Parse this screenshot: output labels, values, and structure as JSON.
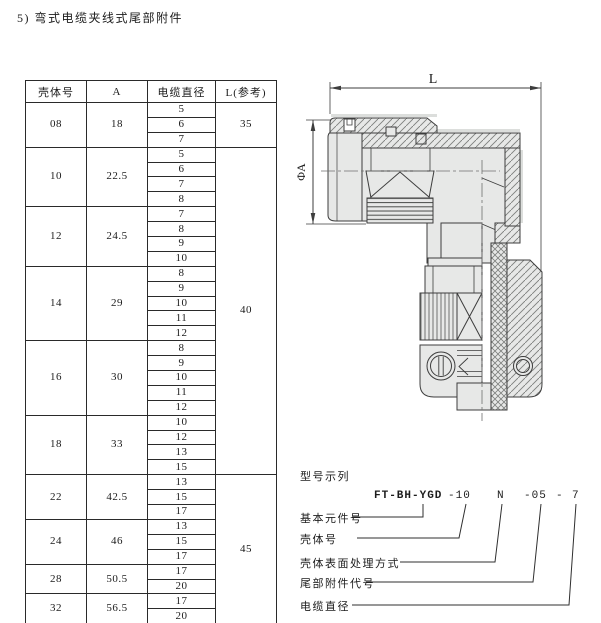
{
  "title": "5) 弯式电缆夹线式尾部附件",
  "colors": {
    "page": "#ffffff",
    "line": "#3d3d3d",
    "body_fill": "#e7e8e7",
    "table_line": "#2a2a2a"
  },
  "table": {
    "headers": [
      "壳体号",
      "A",
      "电缆直径",
      "L(参考)"
    ],
    "groups": [
      {
        "shell": "08",
        "a": "18",
        "diameters": [
          "5",
          "6",
          "7"
        ]
      },
      {
        "shell": "10",
        "a": "22.5",
        "diameters": [
          "5",
          "6",
          "7",
          "8"
        ]
      },
      {
        "shell": "12",
        "a": "24.5",
        "diameters": [
          "7",
          "8",
          "9",
          "10"
        ]
      },
      {
        "shell": "14",
        "a": "29",
        "diameters": [
          "8",
          "9",
          "10",
          "11",
          "12"
        ]
      },
      {
        "shell": "16",
        "a": "30",
        "diameters": [
          "8",
          "9",
          "10",
          "11",
          "12"
        ]
      },
      {
        "shell": "18",
        "a": "33",
        "diameters": [
          "10",
          "12",
          "13",
          "15"
        ]
      },
      {
        "shell": "22",
        "a": "42.5",
        "diameters": [
          "13",
          "15",
          "17"
        ]
      },
      {
        "shell": "24",
        "a": "46",
        "diameters": [
          "13",
          "15",
          "17"
        ]
      },
      {
        "shell": "28",
        "a": "50.5",
        "diameters": [
          "17",
          "20"
        ]
      },
      {
        "shell": "32",
        "a": "56.5",
        "diameters": [
          "17",
          "20"
        ]
      }
    ],
    "l_spans": [
      {
        "value": "35",
        "from_group": 0,
        "to_group": 0
      },
      {
        "value": "40",
        "from_group": 1,
        "to_group": 5
      },
      {
        "value": "45",
        "from_group": 6,
        "to_group": 9
      }
    ]
  },
  "drawing": {
    "dim_length_label": "L",
    "dim_diameter_label": "ΦA"
  },
  "designation": {
    "section_title": "型号示列",
    "code": [
      "FT-BH-YGD",
      "-10",
      "N",
      "-05",
      "-",
      "7"
    ],
    "labels": [
      "基本元件号",
      "壳体号",
      "壳体表面处理方式",
      "尾部附件代号",
      "电缆直径"
    ]
  }
}
